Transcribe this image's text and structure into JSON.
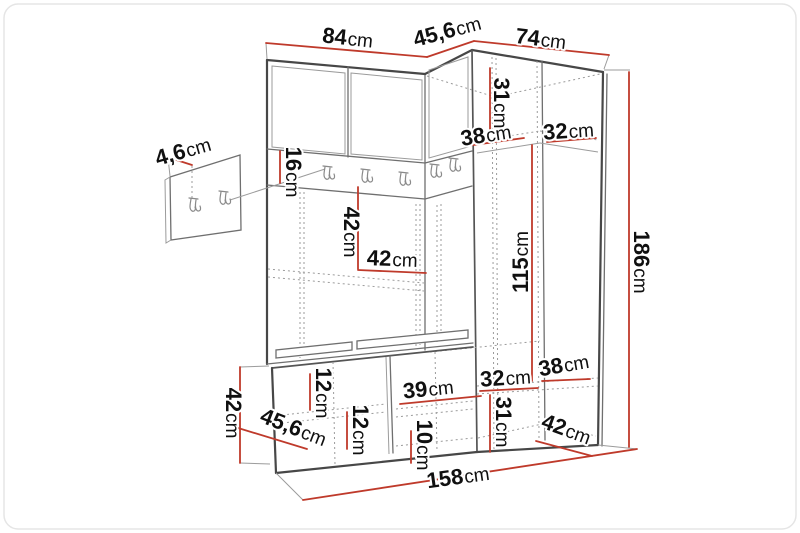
{
  "figure": {
    "type": "furniture-dimension-diagram",
    "subject": "hallway wardrobe set with coat rack, hook panel and shoe bench",
    "unit_of_measure": "cm"
  },
  "dimensions": {
    "top_width_left": {
      "num": "84",
      "unit": "cm"
    },
    "top_depth_corner": {
      "num": "45,6",
      "unit": "cm"
    },
    "top_width_right": {
      "num": "74",
      "unit": "cm"
    },
    "panel_thickness": {
      "num": "4,6",
      "unit": "cm"
    },
    "right_top_compartment_height": {
      "num": "31",
      "unit": "cm"
    },
    "right_shelf_depth_a": {
      "num": "38",
      "unit": "cm"
    },
    "right_shelf_depth_b": {
      "num": "32",
      "unit": "cm"
    },
    "hook_rail_height": {
      "num": "16",
      "unit": "cm"
    },
    "middle_opening_height": {
      "num": "42",
      "unit": "cm"
    },
    "middle_opening_width": {
      "num": "42",
      "unit": "cm"
    },
    "hanging_space_height": {
      "num": "115",
      "unit": "cm"
    },
    "total_height": {
      "num": "186",
      "unit": "cm"
    },
    "lower_shelf_depth_a": {
      "num": "38",
      "unit": "cm"
    },
    "lower_shelf_depth_b": {
      "num": "32",
      "unit": "cm"
    },
    "bench_compartment_width": {
      "num": "39",
      "unit": "cm"
    },
    "lower_compartment_height": {
      "num": "31",
      "unit": "cm"
    },
    "lower_depth": {
      "num": "42",
      "unit": "cm"
    },
    "bench_top_clearance": {
      "num": "12",
      "unit": "cm"
    },
    "bench_inner_height": {
      "num": "12",
      "unit": "cm"
    },
    "bench_plinth_height": {
      "num": "10",
      "unit": "cm"
    },
    "bench_depth": {
      "num": "45,6",
      "unit": "cm"
    },
    "bench_height": {
      "num": "42",
      "unit": "cm"
    },
    "total_width": {
      "num": "158",
      "unit": "cm"
    }
  },
  "colors": {
    "dimension_line": "#bf3a2b",
    "outline": "#474747",
    "hidden_line": "#9b9b9b",
    "background": "#ffffff"
  }
}
